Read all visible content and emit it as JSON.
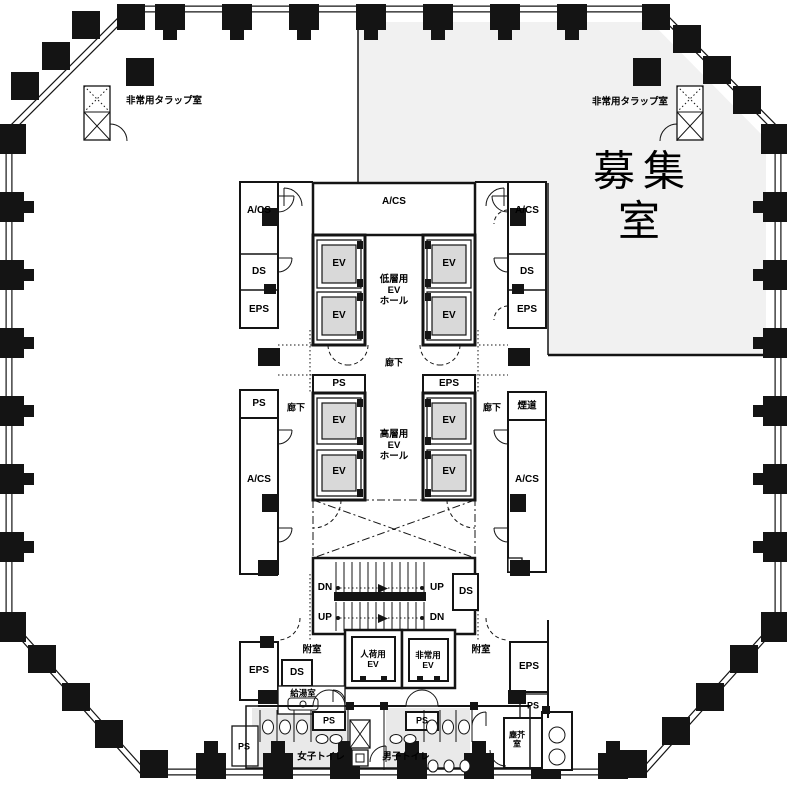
{
  "plan": {
    "colors": {
      "vacant_room_fill": "#f1f1f1",
      "toilet_floor_fill": "#e9e9e9",
      "elevator_car_fill": "#d9d9d9",
      "line": "#141414",
      "background": "#ffffff"
    },
    "region_labels": [
      {
        "n": "emergency-hatch-room-left",
        "text": "非常用タラップ室",
        "x": 164,
        "y": 101,
        "fs": 9.5,
        "w": 600
      },
      {
        "n": "emergency-hatch-room-right",
        "text": "非常用タラップ室",
        "x": 630,
        "y": 102,
        "fs": 9.5,
        "w": 600
      },
      {
        "n": "vacant-room",
        "text": "募集室",
        "x": 643,
        "y": 196,
        "fs": 42,
        "ls": 8,
        "w": 500
      },
      {
        "n": "acs-top-left",
        "text": "A/CS",
        "x": 259,
        "y": 211,
        "fs": 10,
        "w": 700
      },
      {
        "n": "acs-top-center",
        "text": "A/CS",
        "x": 394,
        "y": 202,
        "fs": 10,
        "w": 700
      },
      {
        "n": "acs-top-right",
        "text": "A/CS",
        "x": 527,
        "y": 211,
        "fs": 10,
        "w": 700
      },
      {
        "n": "ds-top-left",
        "text": "DS",
        "x": 259,
        "y": 272,
        "fs": 10,
        "w": 700
      },
      {
        "n": "ds-top-right",
        "text": "DS",
        "x": 527,
        "y": 272,
        "fs": 10,
        "w": 700
      },
      {
        "n": "eps-top-left",
        "text": "EPS",
        "x": 259,
        "y": 310,
        "fs": 10,
        "w": 700
      },
      {
        "n": "eps-top-right",
        "text": "EPS",
        "x": 527,
        "y": 310,
        "fs": 10,
        "w": 700
      },
      {
        "n": "ev-low-1",
        "text": "EV",
        "x": 339,
        "y": 264,
        "fs": 10,
        "w": 700
      },
      {
        "n": "ev-low-2",
        "text": "EV",
        "x": 449,
        "y": 264,
        "fs": 10,
        "w": 700
      },
      {
        "n": "ev-low-3",
        "text": "EV",
        "x": 339,
        "y": 316,
        "fs": 10,
        "w": 700
      },
      {
        "n": "ev-low-4",
        "text": "EV",
        "x": 449,
        "y": 316,
        "fs": 10,
        "w": 700
      },
      {
        "n": "low-ev-hall",
        "text": "低層用\nEV\nホール",
        "x": 394,
        "y": 291,
        "fs": 9.5,
        "w": 600
      },
      {
        "n": "corridor-top",
        "text": "廊下",
        "x": 394,
        "y": 363,
        "fs": 9,
        "w": 600
      },
      {
        "n": "ps-high-top",
        "text": "PS",
        "x": 339,
        "y": 384,
        "fs": 10,
        "w": 700
      },
      {
        "n": "eps-high-top",
        "text": "EPS",
        "x": 449,
        "y": 384,
        "fs": 10,
        "w": 700
      },
      {
        "n": "ps-mid-left",
        "text": "PS",
        "x": 259,
        "y": 404,
        "fs": 10,
        "w": 700
      },
      {
        "n": "corridor-left",
        "text": "廊下",
        "x": 296,
        "y": 408,
        "fs": 9,
        "w": 600
      },
      {
        "n": "corridor-right",
        "text": "廊下",
        "x": 492,
        "y": 408,
        "fs": 9,
        "w": 600
      },
      {
        "n": "flue",
        "text": "煙道",
        "x": 527,
        "y": 406,
        "fs": 9.5,
        "w": 600
      },
      {
        "n": "ev-high-1",
        "text": "EV",
        "x": 339,
        "y": 421,
        "fs": 10,
        "w": 700
      },
      {
        "n": "ev-high-2",
        "text": "EV",
        "x": 449,
        "y": 421,
        "fs": 10,
        "w": 700
      },
      {
        "n": "ev-high-3",
        "text": "EV",
        "x": 339,
        "y": 472,
        "fs": 10,
        "w": 700
      },
      {
        "n": "ev-high-4",
        "text": "EV",
        "x": 449,
        "y": 472,
        "fs": 10,
        "w": 700
      },
      {
        "n": "high-ev-hall",
        "text": "高層用\nEV\nホール",
        "x": 394,
        "y": 446,
        "fs": 9.5,
        "w": 600
      },
      {
        "n": "acs-mid-left",
        "text": "A/CS",
        "x": 259,
        "y": 480,
        "fs": 10,
        "w": 700
      },
      {
        "n": "acs-mid-right",
        "text": "A/CS",
        "x": 527,
        "y": 480,
        "fs": 10,
        "w": 700
      },
      {
        "n": "stairs-dn-upper",
        "text": "DN",
        "x": 325,
        "y": 588,
        "fs": 10,
        "w": 700
      },
      {
        "n": "stairs-up-upper",
        "text": "UP",
        "x": 437,
        "y": 588,
        "fs": 10,
        "w": 700
      },
      {
        "n": "stairs-up-lower",
        "text": "UP",
        "x": 325,
        "y": 618,
        "fs": 10,
        "w": 700
      },
      {
        "n": "stairs-dn-lower",
        "text": "DN",
        "x": 437,
        "y": 618,
        "fs": 10,
        "w": 700
      },
      {
        "n": "ds-stairs",
        "text": "DS",
        "x": 466,
        "y": 592,
        "fs": 10,
        "w": 700
      },
      {
        "n": "vestibule-left",
        "text": "附室",
        "x": 312,
        "y": 650,
        "fs": 9.5,
        "w": 600
      },
      {
        "n": "vestibule-right",
        "text": "附室",
        "x": 481,
        "y": 650,
        "fs": 9.5,
        "w": 600
      },
      {
        "n": "service-ev",
        "text": "人荷用\nEV",
        "x": 373,
        "y": 659,
        "fs": 8.5,
        "w": 600
      },
      {
        "n": "emergency-ev",
        "text": "非常用\nEV",
        "x": 428,
        "y": 660,
        "fs": 8.5,
        "w": 600
      },
      {
        "n": "eps-bottom-left",
        "text": "EPS",
        "x": 259,
        "y": 671,
        "fs": 10,
        "w": 700
      },
      {
        "n": "ds-bottom-left",
        "text": "DS",
        "x": 297,
        "y": 673,
        "fs": 10,
        "w": 700
      },
      {
        "n": "kitchenette",
        "text": "給湯室",
        "x": 303,
        "y": 693,
        "fs": 8.5,
        "w": 600
      },
      {
        "n": "eps-bottom-right",
        "text": "EPS",
        "x": 529,
        "y": 667,
        "fs": 10,
        "w": 700
      },
      {
        "n": "ps-bottom-right",
        "text": "PS",
        "x": 533,
        "y": 706,
        "fs": 9,
        "w": 700
      },
      {
        "n": "ps-toilet-left",
        "text": "PS",
        "x": 329,
        "y": 721,
        "fs": 9,
        "w": 700
      },
      {
        "n": "ps-toilet-right",
        "text": "PS",
        "x": 422,
        "y": 721,
        "fs": 9,
        "w": 700
      },
      {
        "n": "ps-outer-left",
        "text": "PS",
        "x": 244,
        "y": 747,
        "fs": 9,
        "w": 700
      },
      {
        "n": "womens-toilet",
        "text": "女子トイレ",
        "x": 321,
        "y": 757,
        "fs": 9.5,
        "w": 600
      },
      {
        "n": "mens-toilet",
        "text": "男子トイレ",
        "x": 406,
        "y": 757,
        "fs": 9.5,
        "w": 600
      },
      {
        "n": "garbage-room",
        "text": "塵芥\n室",
        "x": 517,
        "y": 740,
        "fs": 8,
        "w": 600
      }
    ]
  }
}
